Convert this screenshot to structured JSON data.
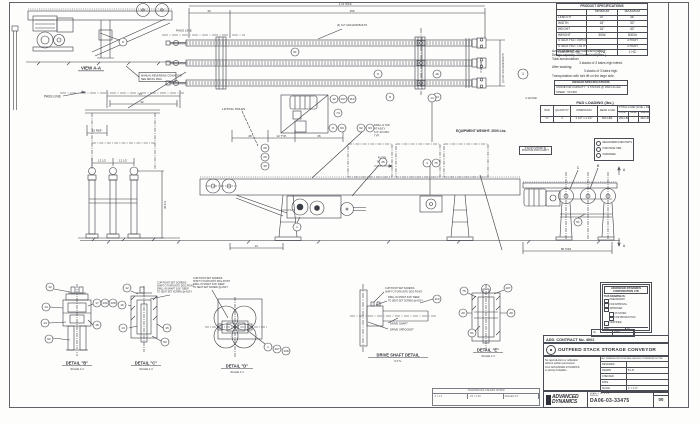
{
  "sheet": {
    "paper_color": "#fdfdfb",
    "line_color": "#3b3d45",
    "text_color": "#2f3138"
  },
  "view_aa": {
    "label": "VIEW A-A",
    "note_line1": "MANUAL REVERSING CONVEYOR",
    "note_line2": "SEE DETAIL DWG",
    "balloon": "8"
  },
  "plan": {
    "dim_total": "174 9/16",
    "dim_156": "156",
    "dim_33": "33",
    "pass_line": "PASS LINE",
    "anchor_note1": "(2) 1/2\" ANCHOR BOLTS",
    "anchor_note2": "(2) 1/2\" ANCHOR BOLTS",
    "pad_note_side": "4 1/2 PAD",
    "pad_note_bottom": "4 1/2 PAD",
    "balloons": [
      "51",
      "9",
      "16",
      "8",
      "14",
      "1"
    ]
  },
  "posts": {
    "pass_line": "PASS LINE",
    "dim_34": "34",
    "dim_32": "32",
    "dim_15": "15 REF.",
    "dim_12a": "12 1/2",
    "dim_12b": "12 1/2",
    "dim_30": "30 1/2"
  },
  "elevation": {
    "lifting_holes": "LIFTING HOLES",
    "dim_28": "28",
    "dim_12typ": "12 TYP.",
    "dim_36": "36",
    "dim_14": "14",
    "drill_note": [
      "DRILL & TAP",
      "AT ASS'Y",
      "1/4\"-20 UNC.",
      "TYP."
    ],
    "flow1": "FLOW",
    "flow2": "50 FPM",
    "balloons_top": [
      "12",
      "107",
      "110"
    ],
    "balloon_74": "74",
    "balloon_8": "8",
    "balloon_60": "60",
    "balloons_left": [
      "28",
      "29",
      "30"
    ],
    "balloon_pair": [
      "62",
      "63"
    ],
    "balloon_35": "35",
    "balloon_4": "4",
    "balloon_76": "76",
    "balloon_14": "14",
    "balloon_1": "1"
  },
  "end_view": {
    "dim_width": "50 5/16",
    "letter_b": "B",
    "letter_c": "C",
    "section_a_top": "A",
    "section_a_bottom": "A",
    "balloon": "51"
  },
  "misc": {
    "equipment_weight": "EQUIPMENT WEIGHT: 2000 Lbs.",
    "phantom_note1": "STACKS SHOWN IN",
    "phantom_note2": "PHANTOM FOR CLARITY"
  },
  "cup_note": [
    "CUP POINT SET SCREWS",
    "SHIP TO TURN INTO DOG POINT",
    "DRILL IN SHAFT 3/16\" DEEP",
    "TO SEAT SET SCREW @ ASS'Y"
  ],
  "details": {
    "b": {
      "title": "DETAIL \"B\"",
      "scale": "SCALE 1:4",
      "balloons": [
        "12",
        "13",
        "14",
        "52",
        "17",
        "106",
        "108",
        "15"
      ]
    },
    "c": {
      "title": "DETAIL \"C\"",
      "scale": "SCALE 1:4",
      "balloons": [
        "12",
        "16",
        "13",
        "15",
        "52"
      ]
    },
    "d": {
      "title": "DETAIL \"D\"",
      "scale": "SCALE 1:4",
      "balloons": [
        "1",
        "107",
        "108"
      ]
    },
    "shaft": {
      "title": "DRIVE SHAFT DETAIL",
      "scale": "N.T.S.",
      "label_shaft": "DRIVE SHAFT",
      "label_sprocket": "DRIVE SPROCKET",
      "balloon": "110"
    },
    "e": {
      "title": "DETAIL \"E\"",
      "scale": "SCALE 1:4",
      "balloons": [
        "75",
        "107",
        "29",
        "28",
        "51"
      ]
    }
  },
  "spec_table": {
    "title": "PRODUCT SPECIFICATIONS",
    "col_min": "MINIMUM",
    "col_max": "MAXIMUM",
    "rows": [
      {
        "label": "LENGTH",
        "min": "20\"",
        "max": "36\""
      },
      {
        "label": "WIDTH",
        "min": "16\"",
        "max": "30\""
      },
      {
        "label": "HEIGHT",
        "min": "16\"",
        "max": "30\""
      },
      {
        "label": "WEIGHT",
        "min": "500#",
        "max": "5000#"
      },
      {
        "label": "STACK HGT. INFEED",
        "min": "",
        "max": "3 HIGH"
      },
      {
        "label": "STACK HGT. OUTFEED",
        "min": "",
        "max": "3 HIGH"
      },
      {
        "label": "LINE RHYTHM",
        "min": "1 HZ",
        "max": "1 HZ"
      }
    ]
  },
  "capacity_notes": {
    "lines": [
      "Actual capacity: 150 bales/shift(8hrs.)",
      "Design capacity: 200 bales/shift(8hrs.)",
      "Total accumulation:",
      "3 stacks of 3 bales high infeed.",
      "After stacking:",
      "3 stacks of 3 bales high.",
      "Transportation with fork lift on the large side."
    ]
  },
  "design_spec": {
    "title": "DESIGN SPECIFICATIONS",
    "line1": "CONVEYOR CAPACITY : 3 STACKS @ 1500 Lbs./EA.",
    "line2": "SPEED : 50 FPM"
  },
  "pad_loading": {
    "title": "PAD LOADING (lbs.)",
    "h_pad": "PAD",
    "h_qty": "QUANTITY",
    "h_dim": "DIMENSION",
    "h_dead": "DEAD LOAD",
    "h_total": "TOTAL LOAD (LIVE + DEAD)",
    "h_cont": "CONT.",
    "h_temp": "TEMP.",
    "h_shear": "SHEAR",
    "row": {
      "pad": "\"A\"",
      "qty": "4",
      "dim": "4 1/2\" x 4 1/2\"",
      "dead": "500 LBS.",
      "cont": "250 LBS.",
      "temp": "-",
      "shear": "400 LBS."
    }
  },
  "legend": {
    "items": [
      "WELD/FABRICATED PARTS",
      "PURCHASE ITEM",
      "HARDWARE"
    ]
  },
  "company_box": {
    "name1": "ADVANCED DYNAMICS",
    "name2": "CORPORATION LTD",
    "heading": "THIS DRAWING IS:",
    "checks": [
      "PRELIMINARY",
      "FOR APPROVAL",
      "APPROVED",
      "AS NOTED",
      "FOR PRODUCTION",
      "CERTIFIED"
    ],
    "date_label": "Date",
    "by_label": "By"
  },
  "title_block": {
    "rev_head": "No.",
    "rev_date": "DATE",
    "contract": "ADD. CONTRACT No. 4002",
    "title": "OUTFEED STACK STORAGE CONVEYOR",
    "disclaimer": [
      "No reproduction or utilization",
      "without written permission",
      "from ADVANCED DYNAMICS",
      "is strictly forbidden."
    ],
    "units_note": "ALL DIMENSIONS IN INCHES UNLESS OTHERWISE NOTED",
    "fields": [
      {
        "label": "DESIGNED",
        "value": ""
      },
      {
        "label": "DRAWN",
        "value": "B.L.B."
      },
      {
        "label": "CHECKED",
        "value": ""
      },
      {
        "label": "DATE",
        "value": ""
      },
      {
        "label": "SCALE",
        "value": "1\" = 1'-0\""
      }
    ],
    "logo_line1": "ADVANCED",
    "logo_line2": "DYNAMICS",
    "scale_note": "SCALE: 1 1/2\" = 1'-0\"",
    "dwg_label": "DWG No.",
    "dwg_no": "DA06-03-33475",
    "rev_label": "REV.",
    "rev": "00"
  },
  "tolerance_box": {
    "title": "TOLERANCES UNLESS NOTED",
    "cells": [
      ".X = ±.1",
      ".XX = ±.03",
      "ANGLES ±1°"
    ]
  }
}
